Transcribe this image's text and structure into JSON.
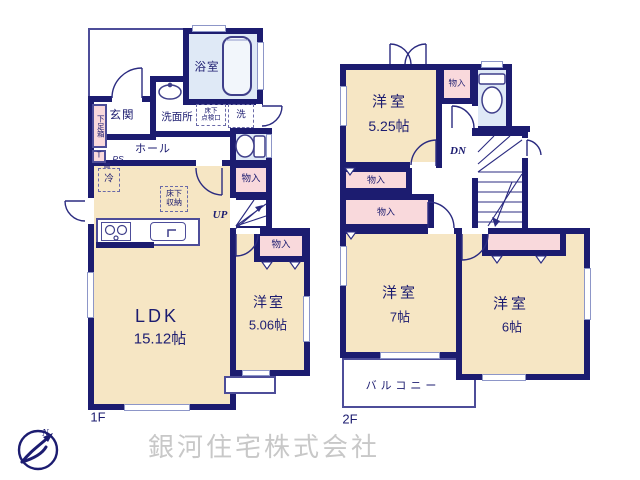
{
  "colors": {
    "wall": "#1c1c70",
    "room_fill": "#f6e6c4",
    "wet_fill": "#dfe9f6",
    "closet_fill": "#f9d9dc",
    "ink": "#1c1c70",
    "watermark": "#c8c8c8"
  },
  "floor1": {
    "label": "1F",
    "entrance": "玄関",
    "bath": "浴室",
    "washroom": "洗面所",
    "underfloor_access_l1": "床下",
    "underfloor_access_l2": "点検口",
    "washer": "洗",
    "shoe_box": "下足箱",
    "shoe_box_t": "T",
    "hall": "ホール",
    "ps": "PS",
    "fridge": "冷",
    "underfloor_storage_l1": "床下",
    "underfloor_storage_l2": "収納",
    "closet_a": "物入",
    "closet_b": "物入",
    "stairs": "UP",
    "ldk": "LDK",
    "ldk_size": "15.12帖",
    "western": "洋室",
    "western_size": "5.06帖"
  },
  "floor2": {
    "label": "2F",
    "western1": "洋室",
    "western1_size": "5.25帖",
    "closet_top": "物入",
    "closet_a": "物入",
    "closet_b": "物入",
    "closet_c": "物入",
    "stairs": "DN",
    "western2": "洋室",
    "western2_size": "7帖",
    "western3": "洋室",
    "western3_size": "6帖",
    "balcony": "バルコニー"
  },
  "footer": {
    "company": "銀河住宅株式会社",
    "compass_n": "N"
  }
}
